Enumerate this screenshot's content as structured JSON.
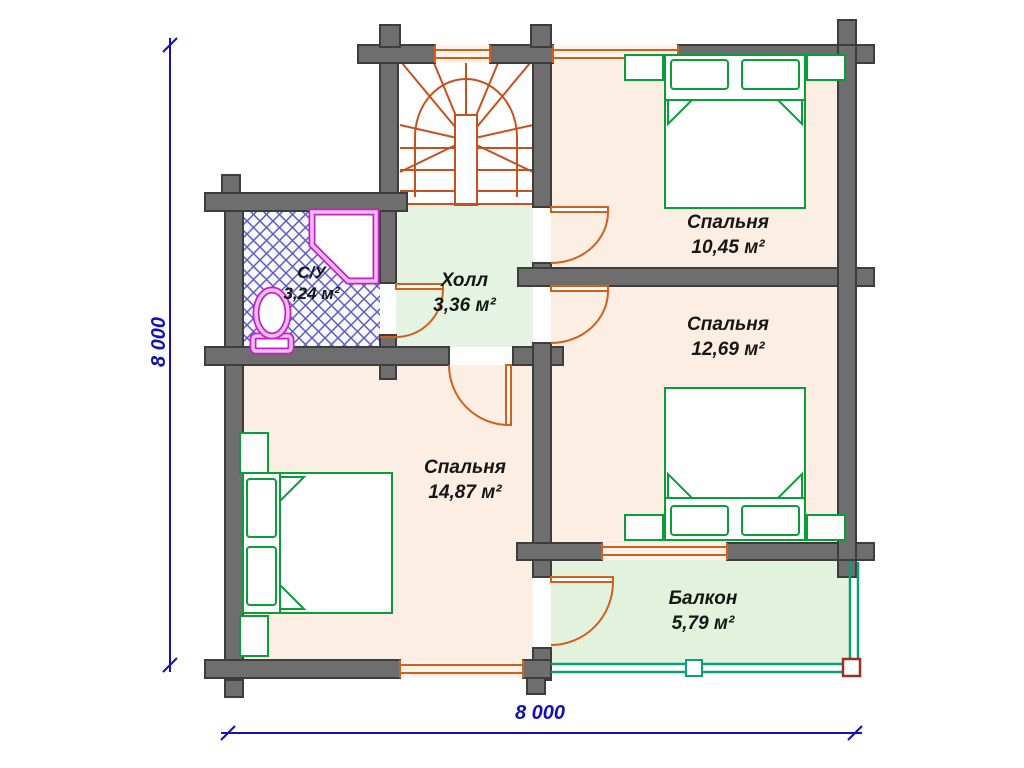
{
  "plan": {
    "rooms": [
      {
        "name": "Спальня",
        "area": "10,45 м²"
      },
      {
        "name": "Спальня",
        "area": "12,69 м²"
      },
      {
        "name": "Спальня",
        "area": "14,87 м²"
      },
      {
        "name": "Холл",
        "area": "3,36 м²"
      },
      {
        "name": "С/У",
        "area": "3,24 м²"
      },
      {
        "name": "Балкон",
        "area": "5,79 м²"
      }
    ],
    "dimensions": {
      "width_label": "8 000",
      "height_label": "8 000"
    },
    "colors": {
      "wall": "#6e6e6e",
      "wallOutline": "#3d3d3d",
      "floorPeach": "#fdeee3",
      "floorHall": "#e4f3e2",
      "floorBalcony": "#e2f2dc",
      "bathHatch": "#5b5bc5",
      "furniture": "#0a9e38",
      "stair": "#c8501e",
      "door": "#d2601a",
      "fixture": "#c422c4",
      "fixtureInner": "#f0bdf0",
      "railing": "#0aa078",
      "dimension": "#1212b8",
      "label": "#161616"
    }
  }
}
